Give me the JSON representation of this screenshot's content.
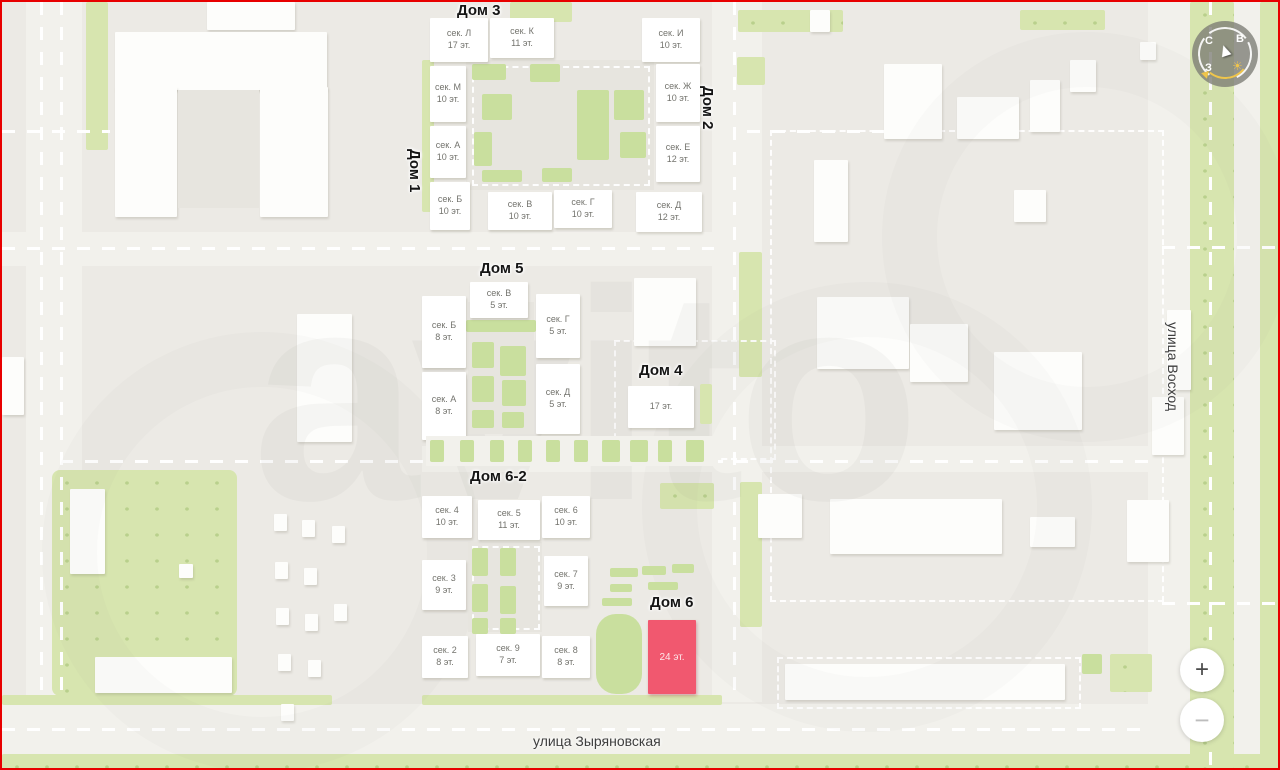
{
  "map": {
    "watermark": "avito",
    "colors": {
      "background": "#ECEAE5",
      "building": "#FFFFFF",
      "green": "#D7E5AF",
      "highlight": "#F1586F",
      "frame_border": "#E80000"
    }
  },
  "streets": [
    {
      "name": "улица Восход",
      "orientation": "vertical"
    },
    {
      "name": "улица Зыряновская",
      "orientation": "horizontal"
    }
  ],
  "houses": [
    {
      "id": "dom-1",
      "label": "Дом 1"
    },
    {
      "id": "dom-2",
      "label": "Дом 2"
    },
    {
      "id": "dom-3",
      "label": "Дом 3",
      "sections": [
        {
          "name": "сек. Л",
          "floors": "17 эт."
        },
        {
          "name": "сек. К",
          "floors": "11 эт."
        },
        {
          "name": "сек. И",
          "floors": "10 эт."
        },
        {
          "name": "сек. М",
          "floors": "10 эт."
        },
        {
          "name": "сек. Ж",
          "floors": "10 эт."
        },
        {
          "name": "сек. А",
          "floors": "10 эт."
        },
        {
          "name": "сек. Е",
          "floors": "12 эт."
        },
        {
          "name": "сек. Б",
          "floors": "10 эт."
        },
        {
          "name": "сек. В",
          "floors": "10 эт."
        },
        {
          "name": "сек. Г",
          "floors": "10 эт."
        },
        {
          "name": "сек. Д",
          "floors": "12 эт."
        }
      ]
    },
    {
      "id": "dom-4",
      "label": "Дом 4",
      "floors": "17 эт."
    },
    {
      "id": "dom-5",
      "label": "Дом 5",
      "sections": [
        {
          "name": "сек. В",
          "floors": "5 эт."
        },
        {
          "name": "сек. Б",
          "floors": "8 эт."
        },
        {
          "name": "сек. Г",
          "floors": "5 эт."
        },
        {
          "name": "сек. А",
          "floors": "8 эт."
        },
        {
          "name": "сек. Д",
          "floors": "5 эт."
        }
      ]
    },
    {
      "id": "dom-6",
      "label": "Дом 6",
      "floors": "24 эт.",
      "highlighted": true
    },
    {
      "id": "dom-6-2",
      "label": "Дом 6-2",
      "sections": [
        {
          "name": "сек. 4",
          "floors": "10 эт."
        },
        {
          "name": "сек. 5",
          "floors": "11 эт."
        },
        {
          "name": "сек. 6",
          "floors": "10 эт."
        },
        {
          "name": "сек. 3",
          "floors": "9 эт."
        },
        {
          "name": "сек. 7",
          "floors": "9 эт."
        },
        {
          "name": "сек. 2",
          "floors": "8 эт."
        },
        {
          "name": "сек. 9",
          "floors": "7 эт."
        },
        {
          "name": "сек. 8",
          "floors": "8 эт."
        }
      ]
    }
  ],
  "controls": {
    "compass": {
      "north": "С",
      "east": "В",
      "west": "З",
      "sun": "☀"
    },
    "zoom_in": "+",
    "zoom_out": "−"
  }
}
